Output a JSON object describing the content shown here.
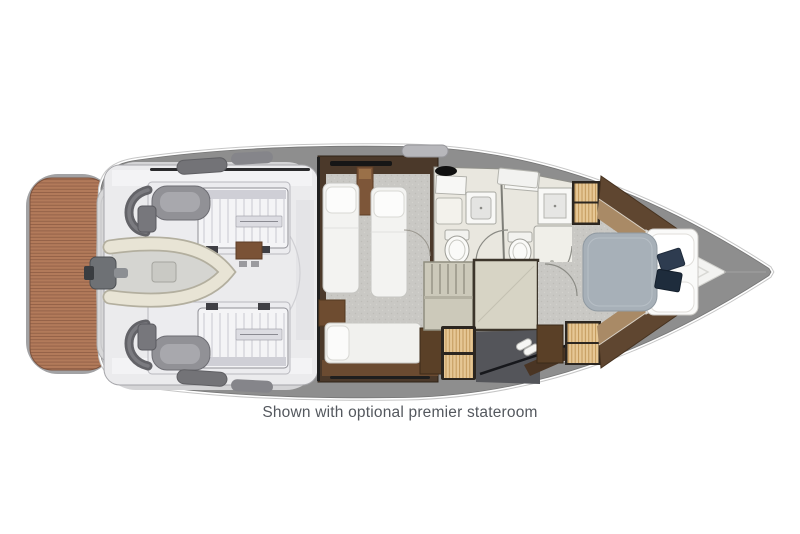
{
  "figure": {
    "title": "Yacht lower deck floor plan",
    "caption": "Shown with optional premier stateroom",
    "palette": {
      "background": "#ffffff",
      "deck": "#8e8e8e",
      "gunwale": "#d4d4d6",
      "teak": "#b27a5a",
      "teak_seam": "#8e5d44",
      "engine_room": "#ebebed",
      "machinery": "#f2f2f4",
      "tender_tube": "#e8e4d5",
      "carpet": "#c9c8c4",
      "wood_dark": "#4b392a",
      "wood_mid": "#6b4b31",
      "tan_slat": "#e6c795",
      "tan_slat_line": "#bf9455",
      "bathroom": "#e9e7df",
      "bed_white": "#fafaf9",
      "mattress_blue_gray": "#a7b0b8",
      "pillow_navy": "#2e3c50",
      "caption_text": "#54585e"
    },
    "elements": [
      "swim-platform",
      "transom-garage-door",
      "engine-room",
      "engine-top",
      "engine-bottom",
      "tender",
      "guest-cabin-twin-beds",
      "guest-berth",
      "guest-head",
      "master-head",
      "master-shower",
      "companionway-stairs",
      "premier-stateroom",
      "hanging-lockers",
      "wardrobes",
      "master-bed",
      "bow-deck"
    ]
  }
}
